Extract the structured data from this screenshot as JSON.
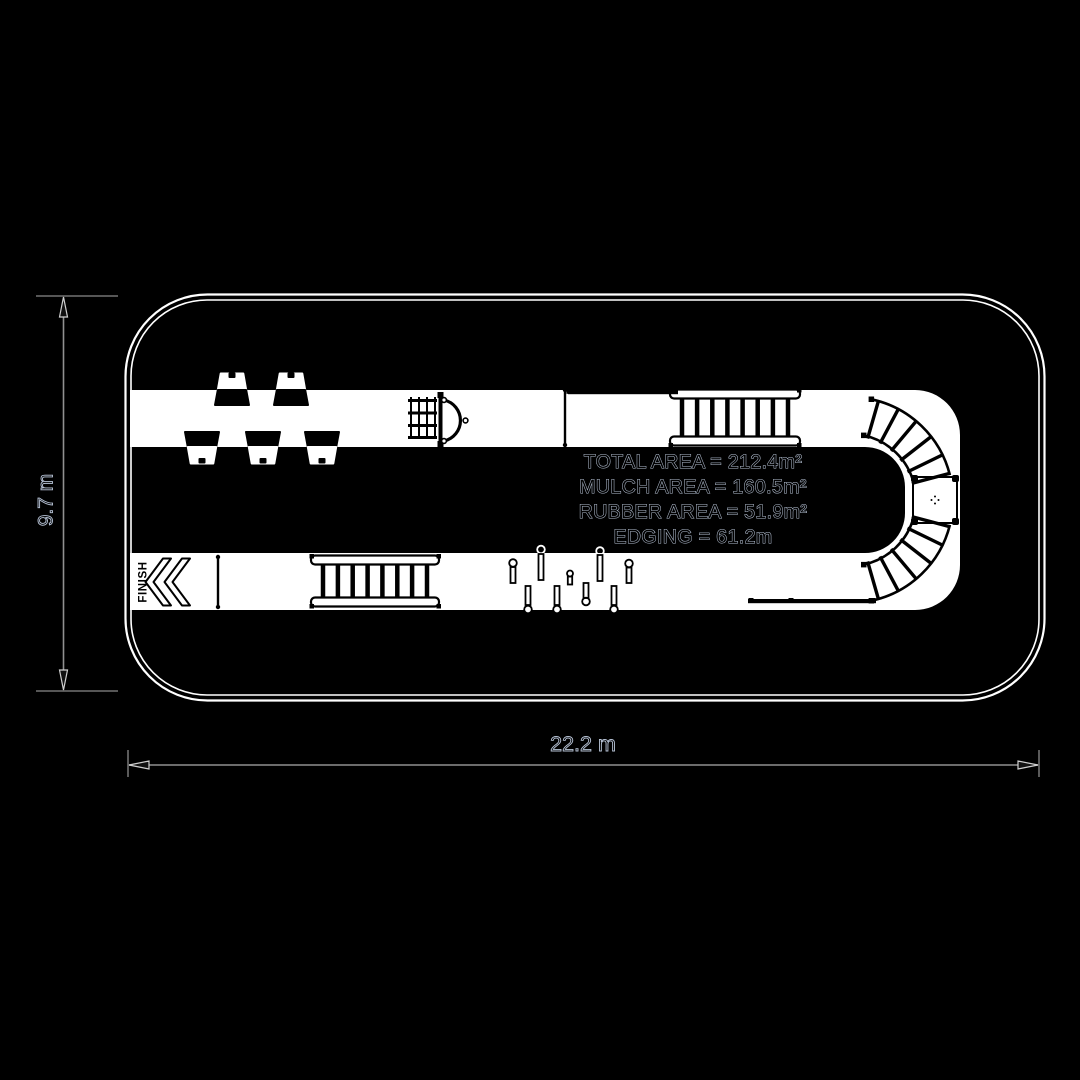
{
  "scene": {
    "background": "#000000",
    "line_color": "#ffffff",
    "outline_text_color": "#b7c3d6",
    "dimension_line_color": "#909090"
  },
  "stats": {
    "total_area": "TOTAL AREA = 212.4m²",
    "mulch_area": "MULCH AREA = 160.5m²",
    "rubber_area": "RUBBER AREA = 51.9m²",
    "edging": "EDGING = 61.2m"
  },
  "dimensions": {
    "height_label": "9.7 m",
    "width_label": "22.2 m"
  },
  "track": {
    "finish_label": "FINISH"
  }
}
